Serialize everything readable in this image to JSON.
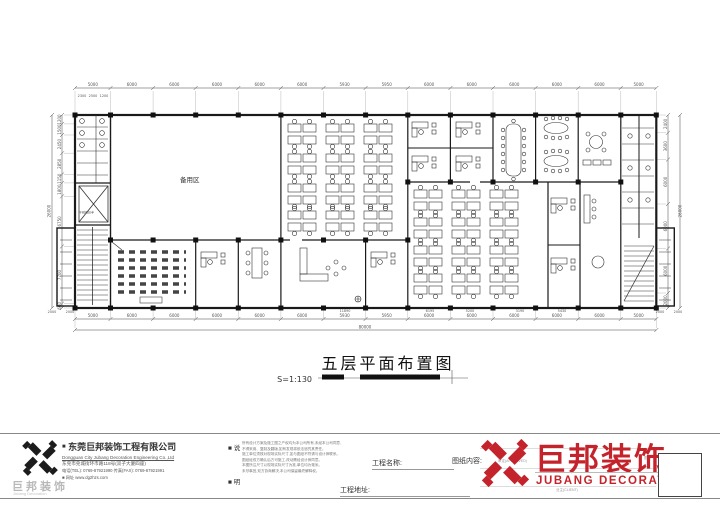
{
  "drawing": {
    "title": "五层平面布置图",
    "scale": "S=1:130",
    "total_width": "80000",
    "total_height": "26000",
    "room_labels": {
      "reserve": "备用区"
    },
    "annotation_stair": "不锈钢扶手",
    "dims": {
      "top": [
        "5000",
        "6000",
        "6000",
        "6000",
        "6000",
        "6000",
        "5930",
        "5950",
        "6000",
        "6000",
        "6000",
        "6000",
        "6000",
        "5000"
      ],
      "top_sub": [
        "2300",
        "2500",
        "1200"
      ],
      "bottom": [
        "5000",
        "6000",
        "6000",
        "6000",
        "6000",
        "6000",
        "5930",
        "5950",
        "6000",
        "6000",
        "6000",
        "6000",
        "6000",
        "5000"
      ],
      "bottom_sub": [
        "11890",
        "6195",
        "5200",
        "3190",
        "5430"
      ],
      "left": [
        "1200",
        "1500",
        "2450",
        "2850",
        "1150",
        "1800",
        "6750",
        "7700",
        "600"
      ],
      "right": [
        "2400",
        "3600",
        "6000",
        "6000",
        "6000",
        "2000"
      ],
      "left_annex": [
        "2000",
        "2000"
      ],
      "right_annex": [
        "2000",
        "2000"
      ]
    }
  },
  "footer": {
    "company": {
      "bullet": "■",
      "name_cn": "东莞巨邦装饰工程有限公司",
      "name_en": "Dongguan City Jubang Decoration Engineering Co.,Ltd",
      "address": "东莞市莞城街环市路118号(双子大厦四座)",
      "tel_fax": "电话(TEL): 0769-87921990    传真(FAX): 0769-87921991",
      "website": "■ 网址 www.dg2hzs.com"
    },
    "notes_label_1": "■ 说",
    "notes_label_2": "■ 明",
    "notes": [
      "所有设计方案及施工图之产权均为本公司所有,未经本公司同意,",
      "不得采用、复制及翻版,如有发现将依法追究其责任。",
      "施工单位须核对现场实际尺寸,如与图纸不符请与设计师联系。",
      "图纸经双方确认后方可施工,改动需经设计师同意。",
      "本图所注尺寸以现场实际尺寸为准,单位均为毫米。",
      "未尽事宜,双方协商解决,本公司保留最终解释权。"
    ],
    "fields": {
      "project_name": "工程名称:",
      "drawing_content": "图纸内容:",
      "project_address": "工程地址:",
      "approved": "审定(APPROVED)",
      "client": "业主(CLIENT)",
      "drawing_no": "图号"
    },
    "logo": {
      "cn": "巨邦装饰",
      "en": "JUBANG DECORATION",
      "red": "#c5232b"
    },
    "left_logo": {
      "cn": "巨邦装饰",
      "en": "Jubang Decoration"
    }
  }
}
